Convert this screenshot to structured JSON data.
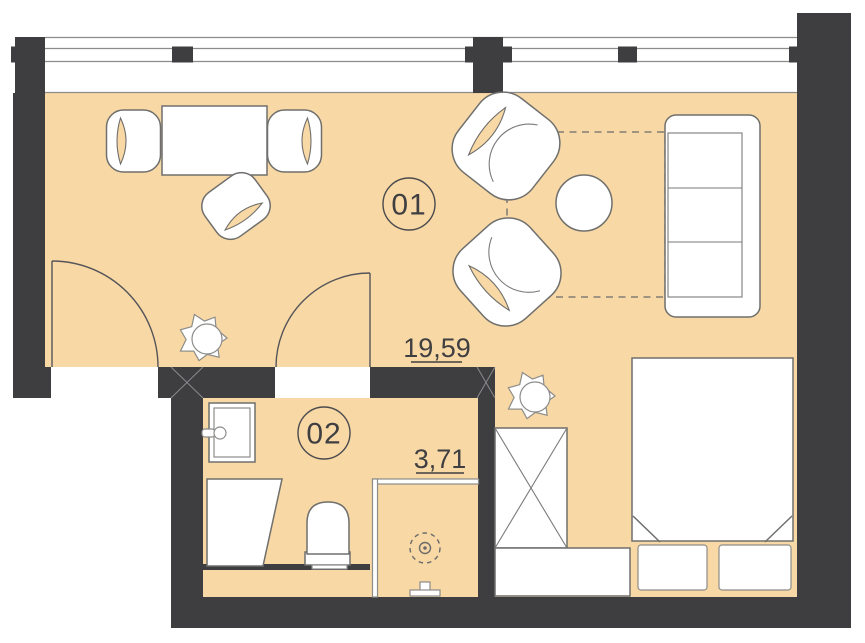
{
  "rooms": [
    {
      "number": "01",
      "area": "19,59"
    },
    {
      "number": "02",
      "area": "3,71"
    }
  ],
  "colors": {
    "floor": "#F8D8A5",
    "wall": "#3E3E40",
    "furniture_outline": "#6F6F6D",
    "thin_line": "#8C8C8A",
    "text": "#3F3F42",
    "background": "#FFFFFF"
  }
}
